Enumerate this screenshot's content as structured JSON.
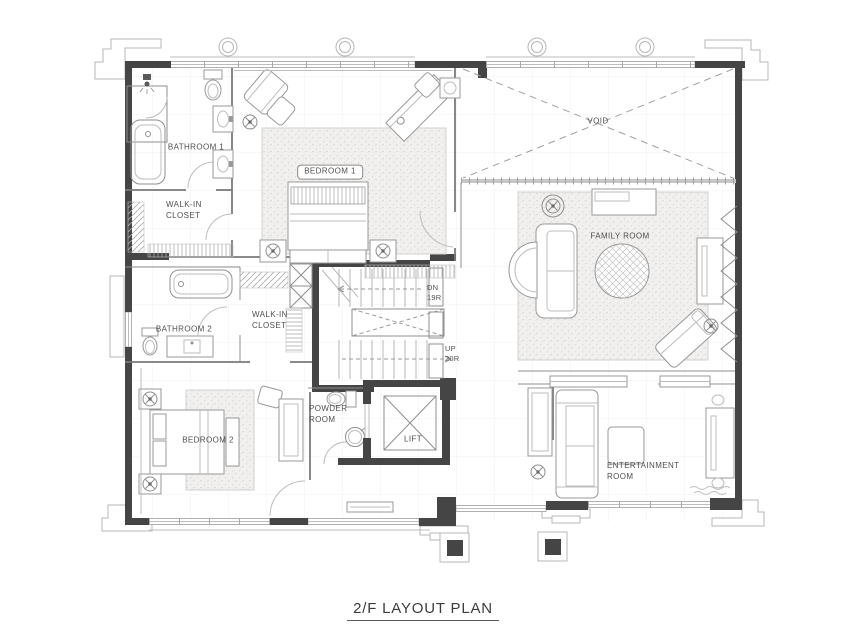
{
  "title": "2/F LAYOUT PLAN",
  "rooms": {
    "bathroom1": {
      "label": "BATHROOM 1"
    },
    "walk_in_closet_1": {
      "label": "WALK-IN\nCLOSET"
    },
    "bedroom1": {
      "label": "BEDROOM 1"
    },
    "void": {
      "label": "VOID"
    },
    "family_room": {
      "label": "FAMILY ROOM"
    },
    "bathroom2": {
      "label": "BATHROOM 2"
    },
    "walk_in_closet_2": {
      "label": "WALK-IN\nCLOSET"
    },
    "bedroom2": {
      "label": "BEDROOM 2"
    },
    "powder_room": {
      "label": "POWDER\nROOM"
    },
    "lift": {
      "label": "LIFT"
    },
    "entertainment_room": {
      "label": "ENTERTAINMENT\nROOM"
    }
  },
  "stairs": {
    "down": {
      "label": "DN\n19R"
    },
    "up": {
      "label": "UP\n20R"
    }
  },
  "colors": {
    "wall": "#454545",
    "line": "#8f8f8f",
    "light_line": "#bdbdbd",
    "label_text": "#4f4f4f"
  }
}
